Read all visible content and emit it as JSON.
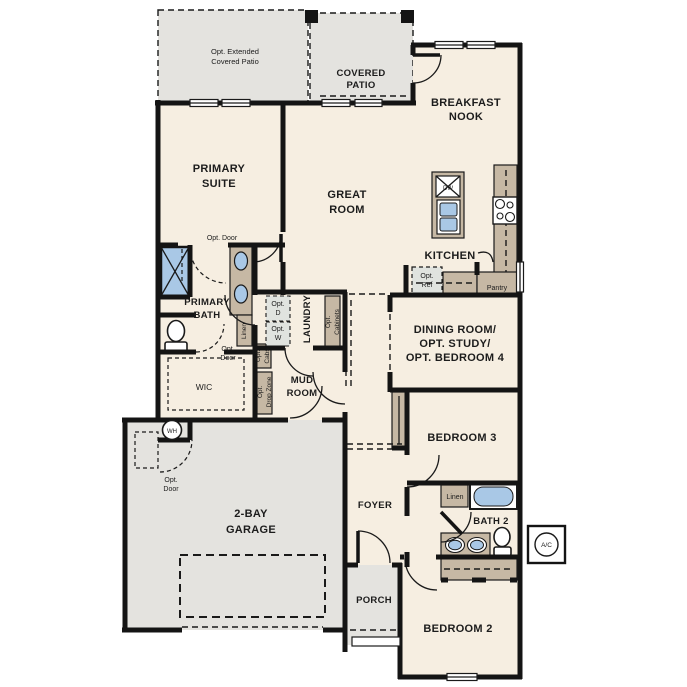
{
  "floorplan": {
    "labels": {
      "opt_extended_patio": [
        "Opt. Extended",
        "Covered Patio"
      ],
      "covered_patio": [
        "COVERED",
        "PATIO"
      ],
      "breakfast_nook": [
        "BREAKFAST",
        "NOOK"
      ],
      "primary_suite": [
        "PRIMARY",
        "SUITE"
      ],
      "great_room": [
        "GREAT",
        "ROOM"
      ],
      "kitchen": "KITCHEN",
      "opt_ref": [
        "Opt.",
        "Ref"
      ],
      "pantry": "Pantry",
      "dining_room": [
        "DINING ROOM/",
        "OPT. STUDY/",
        "OPT. BEDROOM 4"
      ],
      "primary_bath": [
        "PRIMARY",
        "BATH"
      ],
      "opt_door": "Opt. Door",
      "opt_door_2": [
        "Opt.",
        "Door"
      ],
      "linen": "Linen",
      "opt_d": [
        "Opt.",
        "D"
      ],
      "opt_w": [
        "Opt.",
        "W"
      ],
      "laundry": "LAUNDRY",
      "opt_cabinets": [
        "Opt.",
        "Cabinets"
      ],
      "opt_cabs": [
        "Opt.",
        "Cabs"
      ],
      "opt_drop_zone": [
        "Opt.",
        "Drop Zone"
      ],
      "wic": "WIC",
      "mud_room": [
        "MUD",
        "ROOM"
      ],
      "wh": "WH",
      "garage": [
        "2-BAY",
        "GARAGE"
      ],
      "foyer": "FOYER",
      "bedroom_3": "BEDROOM 3",
      "bath_2": "BATH 2",
      "ac": "A/C",
      "porch": "PORCH",
      "bedroom_2": "BEDROOM 2",
      "dw": "DW"
    },
    "colors": {
      "floor": "#f6eee1",
      "outdoor": "#e4e3df",
      "cabinetry": "#c6b8a4",
      "fixture_blue": "#a9c8e6",
      "wall": "#141414",
      "appliance": "#e0e3df"
    }
  }
}
